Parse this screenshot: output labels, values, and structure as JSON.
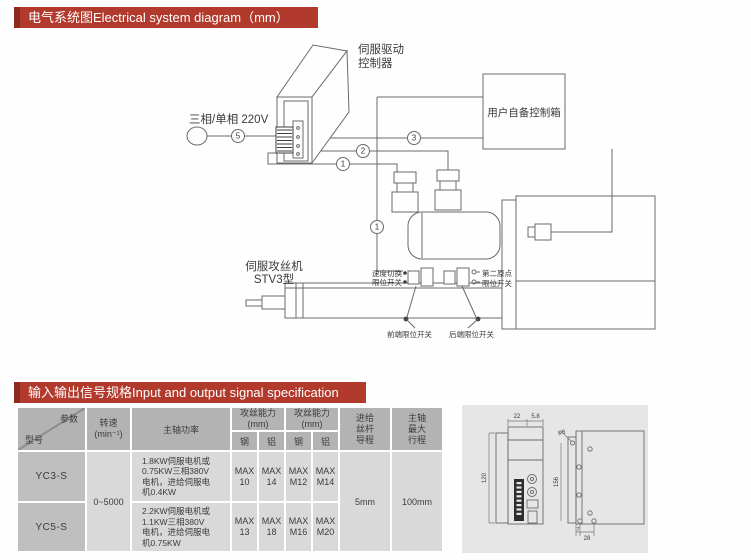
{
  "banners": {
    "electrical": "电气系统图Electrical system diagram（mm）",
    "io": "输入输出信号规格Input and output signal specification",
    "color": "#b23a2c"
  },
  "diagram": {
    "labels": {
      "drive_line1": "伺服驱动",
      "drive_line2": "控制器",
      "power_source": "三相/单相 220V",
      "control_box": "用户自备控制箱",
      "machine_line1": "伺服攻丝机",
      "machine_line2": "STV3型",
      "speed_switch_line1": "速度切换",
      "speed_switch_line2": "限位开关",
      "second_origin_line1": "第二原点",
      "second_origin_line2": "限位开关",
      "front_limit": "前端限位开关",
      "rear_limit": "后端限位开关"
    },
    "callouts": {
      "c5": "5",
      "c3": "3",
      "c2": "2",
      "c1a": "1",
      "c1b": "1"
    }
  },
  "table": {
    "header": {
      "param": "参数",
      "model": "型号",
      "speed": "转速\n(min⁻¹)",
      "power": "主轴功率",
      "tap": "攻丝能力\n(mm)",
      "steel": "钢",
      "alu": "铝",
      "feed": "进给\n丝杆\n导程",
      "stroke": "主轴\n最大\n行程"
    },
    "rows": [
      {
        "model": "YC3-S",
        "power": "1.8KW伺服电机或\n0.75KW三相380V\n电机，进给伺服电\n机0.4KW",
        "caps": [
          "MAX\n10",
          "MAX\n14",
          "MAX\nM12",
          "MAX\nM14"
        ]
      },
      {
        "model": "YC5-S",
        "power": "2.2KW伺服电机或\n1.1KW三相380V\n电机，进给伺服电\n机0.75KW",
        "caps": [
          "MAX\n13",
          "MAX\n18",
          "MAX\nM16",
          "MAX\nM20"
        ]
      }
    ],
    "speed_value": "0~5000",
    "feed_value": "5mm",
    "stroke_value": "100mm"
  },
  "drawing": {
    "dims": {
      "top_left": "22",
      "top_right": "5.8",
      "front_height": "120",
      "hole": "φ6",
      "side_height": "156",
      "bottom_left": "7",
      "bottom_right": "28"
    }
  }
}
